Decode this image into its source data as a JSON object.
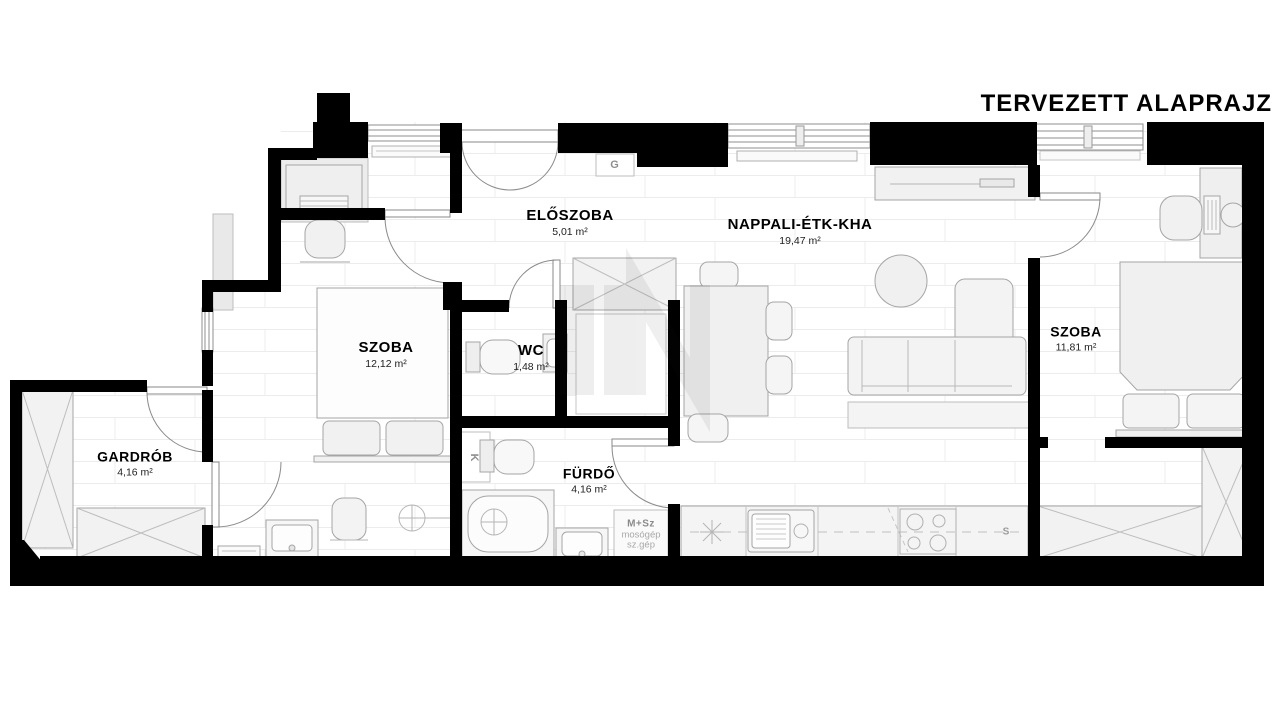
{
  "title": "TERVEZETT ALAPRAJZ",
  "rooms": [
    {
      "id": "eloszoba",
      "name": "ELŐSZOBA",
      "area": "5,01 m²"
    },
    {
      "id": "nappali",
      "name": "NAPPALI-ÉTK-KHA",
      "area": "19,47 m²"
    },
    {
      "id": "szoba-bal",
      "name": "SZOBA",
      "area": "12,12 m²"
    },
    {
      "id": "wc",
      "name": "WC",
      "area": "1,48 m²"
    },
    {
      "id": "gardrob",
      "name": "GARDRÓB",
      "area": "4,16 m²"
    },
    {
      "id": "furdo",
      "name": "FÜRDŐ",
      "area": "4,16 m²"
    },
    {
      "id": "szoba-jobb",
      "name": "SZOBA",
      "area": "11,81 m²"
    }
  ],
  "small_labels": {
    "gas_meter": "G",
    "boiler": "K",
    "counter_section": "S",
    "washer_title": "M+Sz",
    "washer_line1": "mosógép",
    "washer_line2": "sz.gép"
  },
  "colors": {
    "wall": "#000000",
    "furniture_fill": "#f2f2f2",
    "furniture_stroke": "#a5a5a5",
    "floor_line": "#ececec",
    "label_text": "#000000",
    "muted_text": "#9a9a9a"
  }
}
